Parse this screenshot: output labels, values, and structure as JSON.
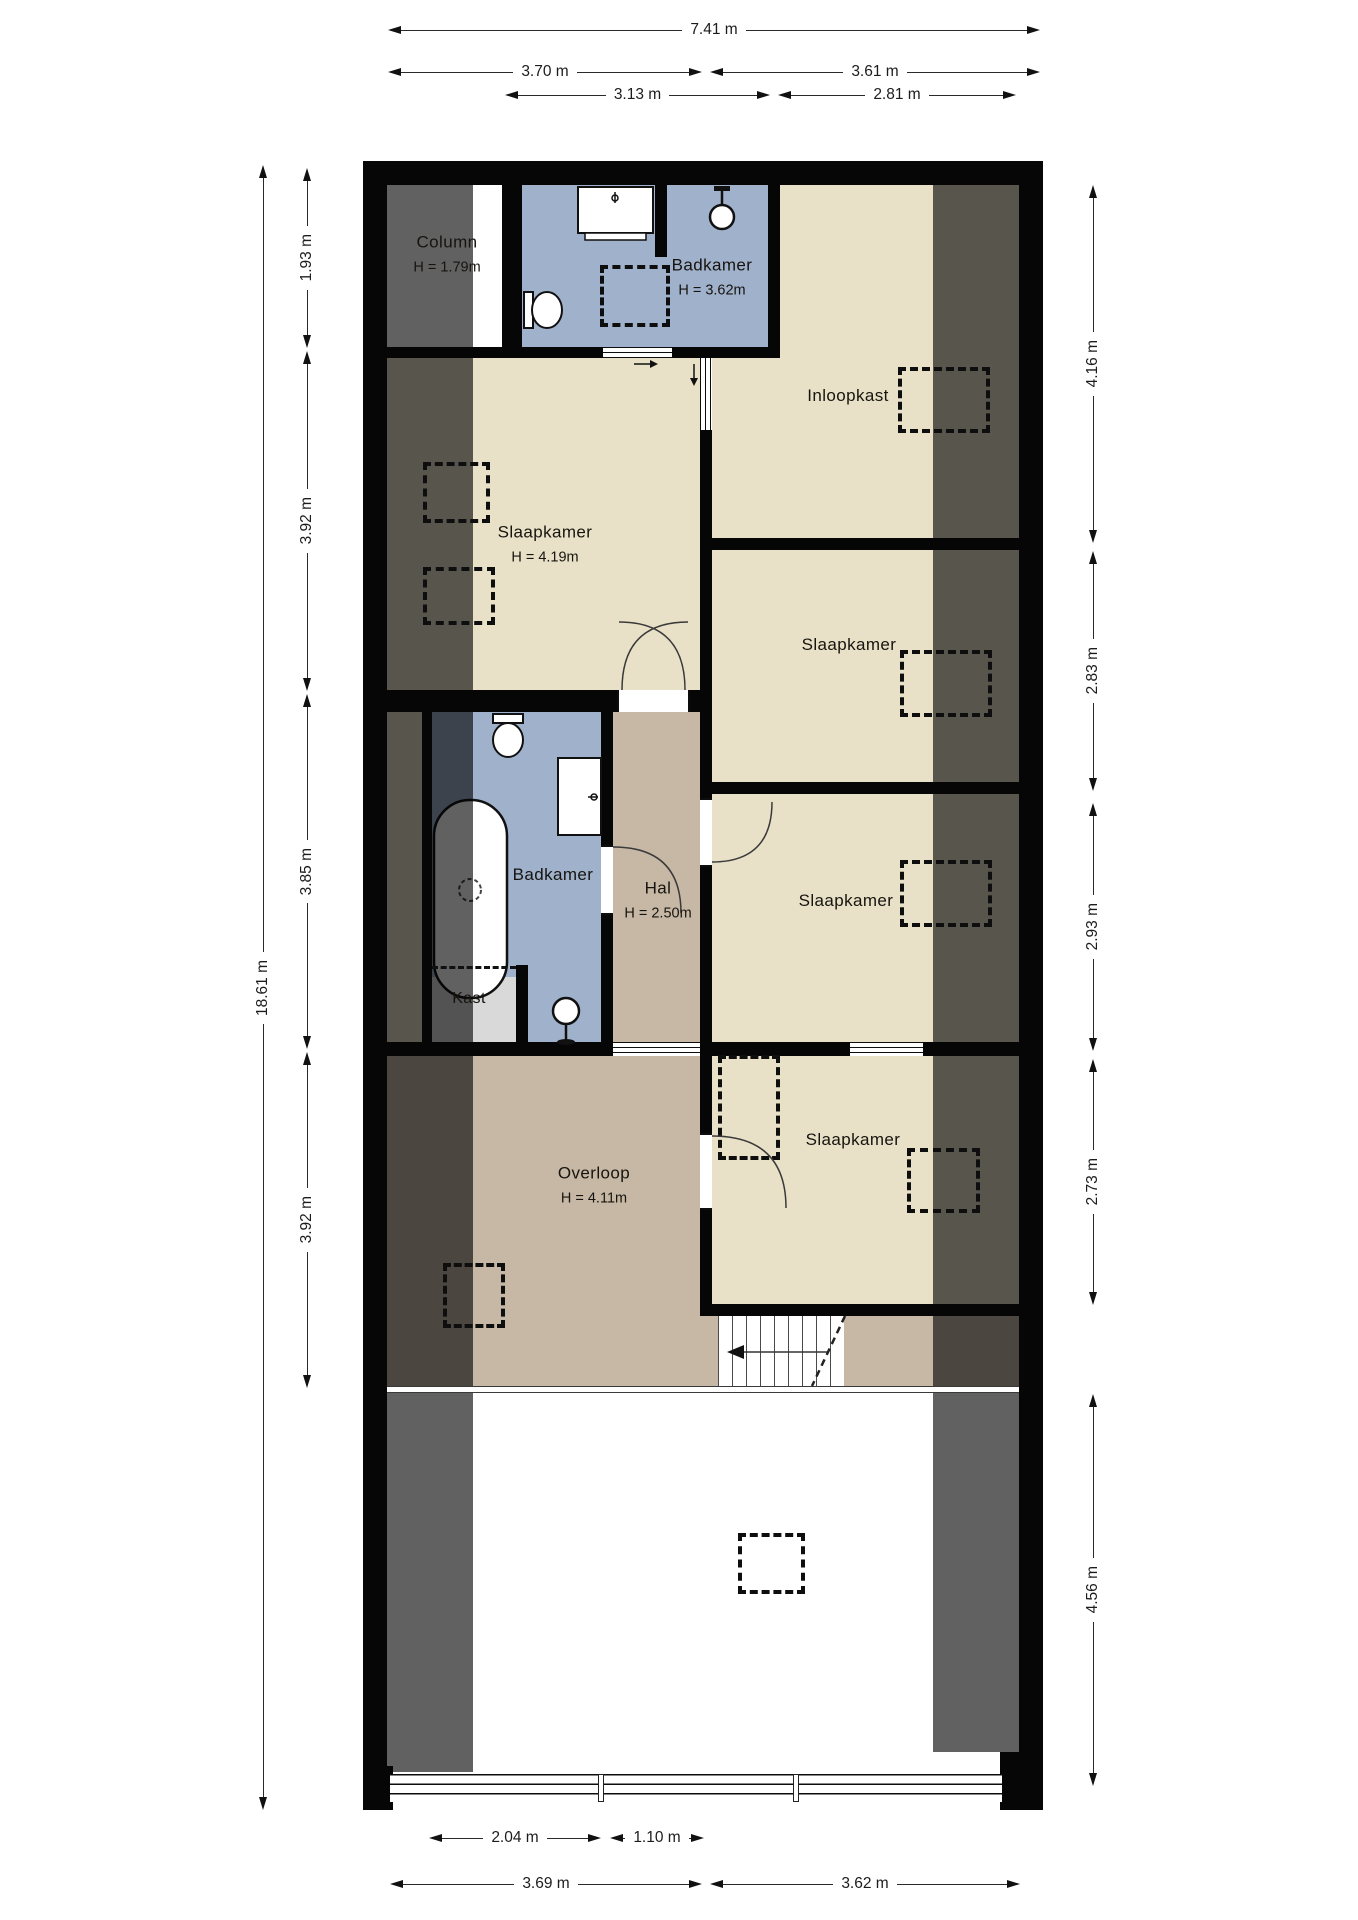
{
  "floorplan": {
    "rooms": {
      "column": {
        "label": "Column",
        "height": "H = 1.79m"
      },
      "badkamer_top": {
        "label": "Badkamer",
        "height": "H = 3.62m"
      },
      "inloopkast": {
        "label": "Inloopkast"
      },
      "slaapkamer_1": {
        "label": "Slaapkamer",
        "height": "H = 4.19m"
      },
      "slaapkamer_2": {
        "label": "Slaapkamer"
      },
      "slaapkamer_3": {
        "label": "Slaapkamer"
      },
      "slaapkamer_4": {
        "label": "Slaapkamer"
      },
      "badkamer_mid": {
        "label": "Badkamer"
      },
      "hal": {
        "label": "Hal",
        "height": "H = 2.50m"
      },
      "kast": {
        "label": "Kast"
      },
      "overloop": {
        "label": "Overloop",
        "height": "H = 4.11m"
      }
    },
    "dimensions": {
      "top": {
        "total": "7.41 m",
        "split": [
          "3.70 m",
          "3.61 m"
        ],
        "inner": [
          "3.13 m",
          "2.81 m"
        ]
      },
      "left": {
        "total": "18.61 m",
        "segments": [
          "1.93 m",
          "3.92 m",
          "3.85 m",
          "3.92 m"
        ]
      },
      "right": {
        "segments": [
          "4.16 m",
          "2.83 m",
          "2.93 m",
          "2.73 m",
          "4.56 m"
        ]
      },
      "bottom": {
        "inner": [
          "2.04 m",
          "1.10 m"
        ],
        "outer": [
          "3.69 m",
          "3.62 m"
        ]
      }
    },
    "colors": {
      "wall": "#060606",
      "room_beige": "#e8e1c7",
      "hall_tan": "#c6b8a5",
      "bath_blue": "#9fb1cb",
      "closet_gray": "#d9d9d9",
      "low_ceiling_overlay": "rgba(0,0,0,0.62)"
    },
    "icons": [
      "roof-window-icon",
      "toilet-icon",
      "sink-icon",
      "bathtub-icon",
      "shower-icon",
      "pendant-light-icon",
      "door-swing-icon",
      "stairs-arrow-icon"
    ]
  }
}
